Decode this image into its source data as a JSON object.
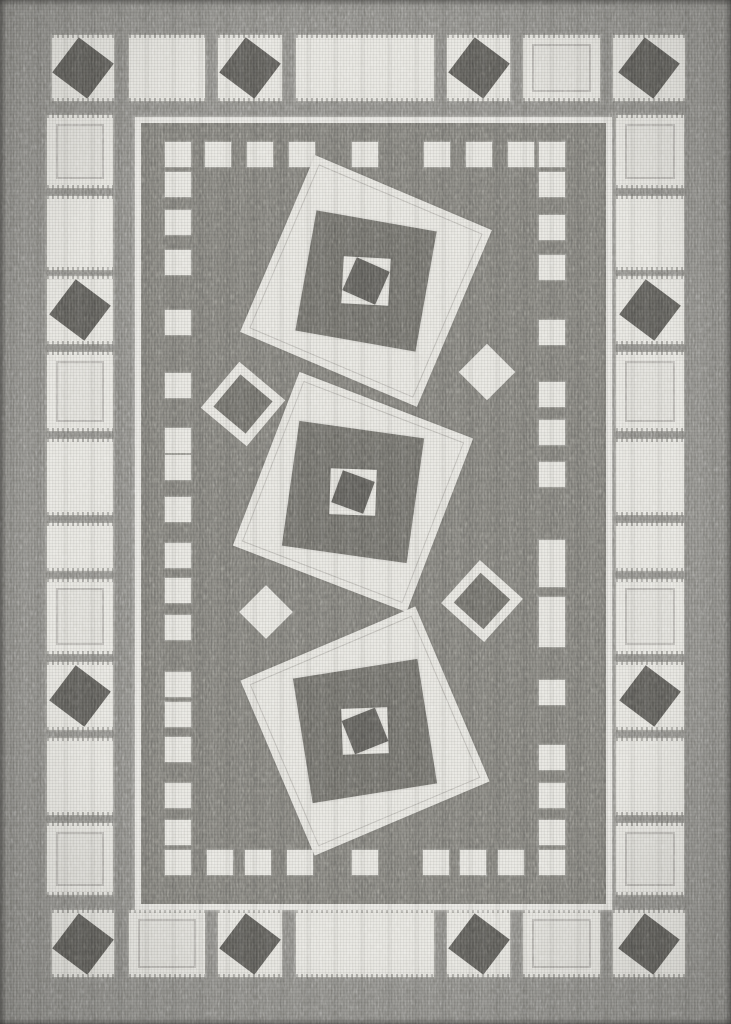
{
  "scene": {
    "description": "Gray and cream flatweave geometric area rug, portrait orientation, with cream square border band, dotted inner border and three tilted nested-square motifs",
    "width": 731,
    "height": 1024
  },
  "colors": {
    "outer": "#8b8a85",
    "field": "#7d7c77",
    "cream": "#e5e4de",
    "cream_dim": "#dfded8",
    "dark_square": "#5d5c58",
    "motif_dark": "#6f6e69",
    "motif_core": "#5f5e5a",
    "frame": "#e6e5e0",
    "stitch": "rgba(125,124,119,0.38)"
  },
  "border_band": {
    "top_row": {
      "y": 35,
      "h": 66,
      "cells": [
        {
          "x": 52,
          "w": 62,
          "type": "dark"
        },
        {
          "x": 129,
          "w": 76,
          "type": "plain"
        },
        {
          "x": 218,
          "w": 64,
          "type": "dark"
        },
        {
          "x": 296,
          "w": 138,
          "type": "plain"
        },
        {
          "x": 447,
          "w": 63,
          "type": "dark"
        },
        {
          "x": 523,
          "w": 77,
          "type": "outline"
        },
        {
          "x": 613,
          "w": 72,
          "type": "dark"
        }
      ]
    },
    "bottom_row": {
      "y": 910,
      "h": 67,
      "cells": [
        {
          "x": 52,
          "w": 62,
          "type": "dark"
        },
        {
          "x": 129,
          "w": 76,
          "type": "outline"
        },
        {
          "x": 218,
          "w": 64,
          "type": "dark"
        },
        {
          "x": 296,
          "w": 138,
          "type": "plain"
        },
        {
          "x": 447,
          "w": 63,
          "type": "dark"
        },
        {
          "x": 523,
          "w": 77,
          "type": "outline"
        },
        {
          "x": 613,
          "w": 72,
          "type": "dark"
        }
      ]
    },
    "left_col": {
      "x": 47,
      "w": 66
    },
    "right_col": {
      "x": 616,
      "w": 68
    },
    "col_cells": [
      {
        "y": 115,
        "h": 73,
        "type": "outline"
      },
      {
        "y": 196,
        "h": 74,
        "type": "plain"
      },
      {
        "y": 276,
        "h": 68,
        "type": "dark"
      },
      {
        "y": 352,
        "h": 79,
        "type": "outline"
      },
      {
        "y": 439,
        "h": 76,
        "type": "plain"
      },
      {
        "y": 523,
        "h": 48,
        "type": "plain"
      },
      {
        "y": 579,
        "h": 75,
        "type": "outline"
      },
      {
        "y": 662,
        "h": 68,
        "type": "dark"
      },
      {
        "y": 738,
        "h": 77,
        "type": "plain"
      },
      {
        "y": 823,
        "h": 72,
        "type": "outline"
      }
    ],
    "diamond": {
      "size": 44,
      "rot": 37
    }
  },
  "inner_frame": {
    "x": 135,
    "y": 117,
    "w": 465,
    "h": 781,
    "border": 6
  },
  "dotted_border": {
    "size_w": 26,
    "size_h": 25,
    "top_y": 142,
    "top_xs": [
      205,
      247,
      289,
      352,
      424,
      466,
      508
    ],
    "bottom_y": 850,
    "bottom_xs": [
      207,
      245,
      287,
      352,
      423,
      460,
      498
    ],
    "left_x": 165,
    "left_ys": [
      142,
      172,
      210,
      250,
      310,
      373,
      428,
      455,
      497,
      543,
      578,
      615,
      672,
      702,
      737,
      783,
      820,
      850
    ],
    "right_x": 539,
    "right_ys": [
      142,
      172,
      215,
      255,
      320,
      382,
      420,
      462,
      540,
      562,
      597,
      622,
      680,
      745,
      783,
      820,
      850
    ]
  },
  "motifs": [
    {
      "cx": 366,
      "cy": 281,
      "layers": [
        {
          "size": 192,
          "color": "cream",
          "rot": 23,
          "stitch": true
        },
        {
          "size": 122,
          "color": "motif_dark",
          "rot": 10,
          "stitch": true
        },
        {
          "size": 47,
          "color": "cream",
          "rot": 3,
          "stitch": false
        },
        {
          "size": 36,
          "color": "motif_core",
          "rot": 24,
          "stitch": false
        }
      ]
    },
    {
      "cx": 353,
      "cy": 492,
      "layers": [
        {
          "size": 186,
          "color": "cream",
          "rot": 21,
          "stitch": true
        },
        {
          "size": 126,
          "color": "motif_dark",
          "rot": 8,
          "stitch": true
        },
        {
          "size": 46,
          "color": "cream",
          "rot": 2,
          "stitch": false
        },
        {
          "size": 34,
          "color": "motif_core",
          "rot": 20,
          "stitch": false
        }
      ]
    },
    {
      "cx": 365,
      "cy": 731,
      "layers": [
        {
          "size": 190,
          "color": "cream",
          "rot": -23,
          "stitch": true
        },
        {
          "size": 126,
          "color": "motif_dark",
          "rot": -9,
          "stitch": true
        },
        {
          "size": 46,
          "color": "cream",
          "rot": -2,
          "stitch": false
        },
        {
          "size": 36,
          "color": "motif_core",
          "rot": -22,
          "stitch": false
        }
      ]
    }
  ],
  "scatter_diamonds": [
    {
      "cx": 487,
      "cy": 372,
      "size": 40,
      "rot": 45,
      "style": "solid"
    },
    {
      "cx": 243,
      "cy": 404,
      "size": 42,
      "rot": 40,
      "style": "outline"
    },
    {
      "cx": 266,
      "cy": 612,
      "size": 38,
      "rot": 45,
      "style": "solid"
    },
    {
      "cx": 482,
      "cy": 601,
      "size": 40,
      "rot": 42,
      "style": "outline"
    }
  ]
}
